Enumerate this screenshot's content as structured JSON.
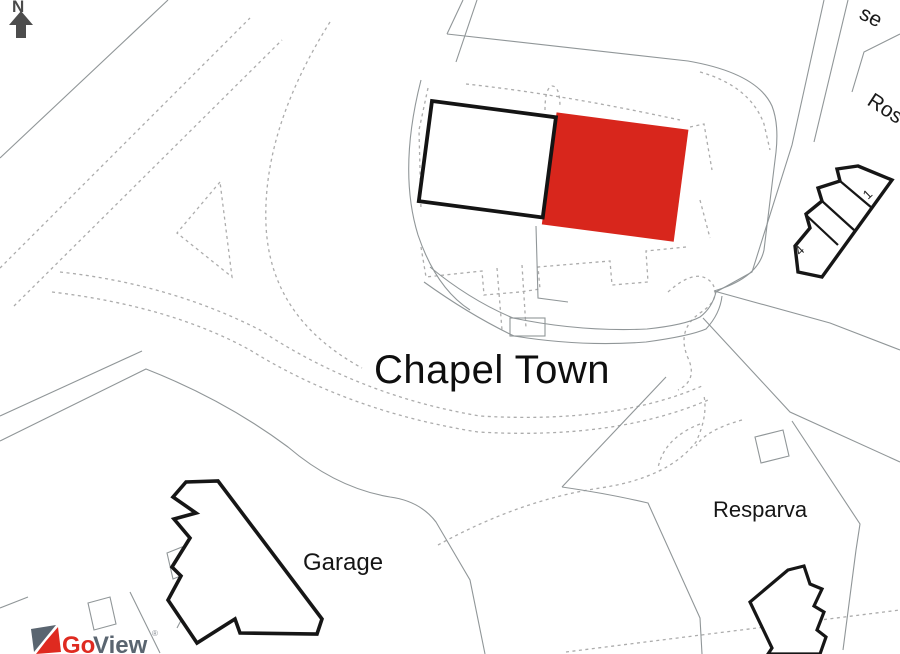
{
  "map": {
    "labels": {
      "place": "Chapel Town",
      "garage": "Garage",
      "resparva": "Resparva",
      "street_partial_right": "Ros",
      "street_partial_top": "se",
      "house_number_1": "1",
      "house_number_4": "4"
    },
    "compass": {
      "north": "N"
    },
    "logo": {
      "go": "Go",
      "view": "View",
      "mark": "®"
    },
    "colors": {
      "highlight_red": "#d8261c",
      "logo_red": "#df2a20",
      "logo_gray": "#5a6570",
      "building_outline": "#161616",
      "boundary_line": "#909698",
      "dashed_line": "#acacac"
    }
  }
}
